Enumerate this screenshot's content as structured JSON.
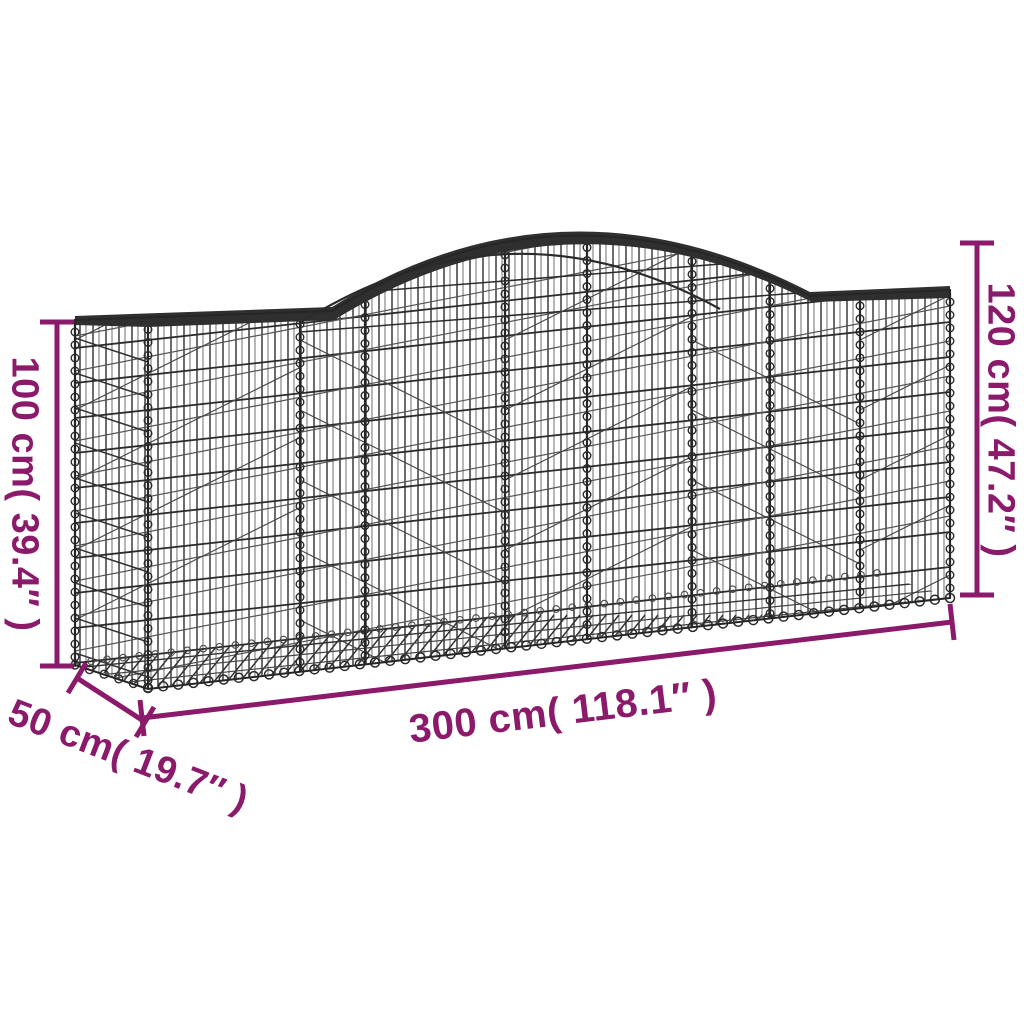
{
  "diagram": {
    "product": "arched gabion wire-mesh basket",
    "labels": {
      "height_left": "100 cm( 39.4″ )",
      "height_right": "120 cm( 47.2″ )",
      "length_bottom": "300 cm( 118.1″ )",
      "depth": "50 cm( 19.7″ )"
    },
    "colors": {
      "dimension": "#8B1A6B",
      "wire": "#2D2D2D",
      "background": "#FFFFFF"
    }
  }
}
